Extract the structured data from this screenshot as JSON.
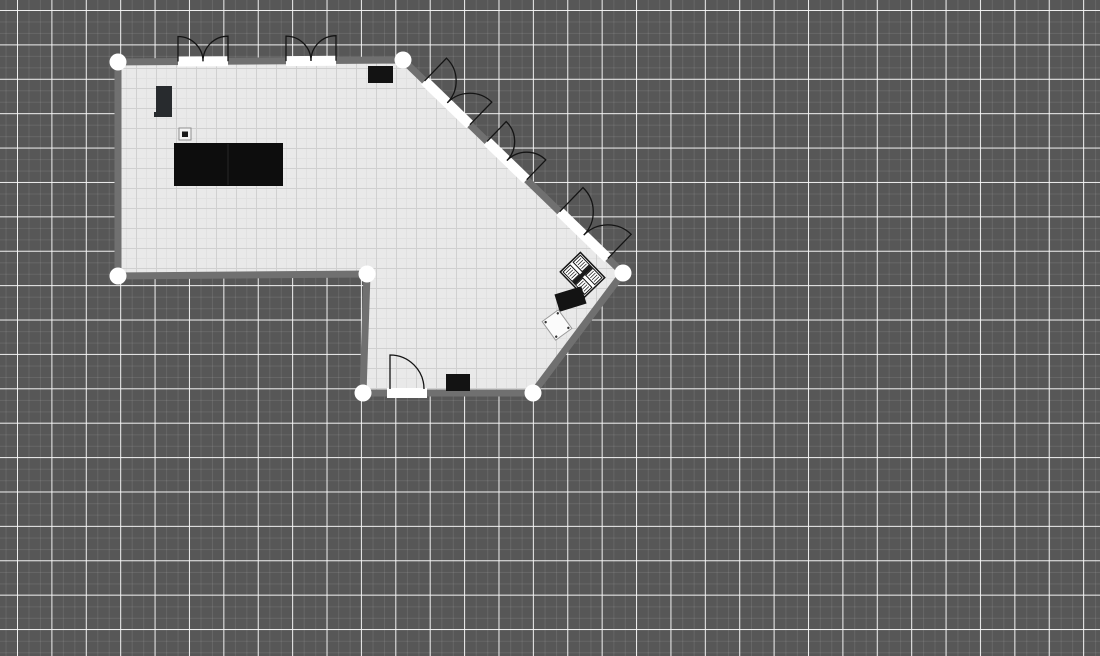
{
  "canvas": {
    "width": 1100,
    "height": 656,
    "tool": "floor-plan-editor-canvas"
  },
  "colors": {
    "canvas_background": "#575757",
    "grid_major": "#f2f2f2",
    "grid_fine": "#666666",
    "floor": "#e9e9e9",
    "floor_grid_minor": "#e1e1e1",
    "floor_grid_major": "#d0d0d0",
    "wall": "#707070",
    "opening": "#ffffff",
    "door_arc": "#141414",
    "vertex": "#ffffff",
    "furniture_dark": "#131313",
    "furniture_charcoal": "#282b2e"
  },
  "plan": {
    "room": {
      "polygon": [
        [
          118,
          62
        ],
        [
          403,
          60
        ],
        [
          623,
          273
        ],
        [
          533,
          393
        ],
        [
          363,
          393
        ],
        [
          367,
          274
        ],
        [
          118,
          276
        ]
      ],
      "wall_thickness": 7
    },
    "vertices": {
      "radius": 8.5,
      "points": [
        [
          118,
          62
        ],
        [
          403,
          60
        ],
        [
          623,
          273
        ],
        [
          533,
          393
        ],
        [
          363,
          393
        ],
        [
          367,
          274
        ],
        [
          118,
          276
        ]
      ]
    },
    "openings": [
      {
        "name": "top-door-opening-1",
        "x1": 178,
        "y1": 61.5,
        "x2": 228,
        "y2": 61.2
      },
      {
        "name": "top-door-opening-2",
        "x1": 286,
        "y1": 61.1,
        "x2": 336,
        "y2": 60.7
      },
      {
        "name": "diag-door-opening-1",
        "x1": 424.6,
        "y1": 80.9,
        "x2": 469.9,
        "y2": 124.7
      },
      {
        "name": "diag-door-opening-2",
        "x1": 487.1,
        "y1": 141.4,
        "x2": 526.7,
        "y2": 179.7
      },
      {
        "name": "diag-door-opening-3",
        "x1": 559.7,
        "y1": 211.7,
        "x2": 607.9,
        "y2": 258.4
      },
      {
        "name": "bottom-door-opening",
        "x1": 387,
        "y1": 393,
        "x2": 427,
        "y2": 393
      }
    ],
    "door_arcs": [
      {
        "name": "top-door-1-left-leaf",
        "path": "M178,61.5 L178,36.5 A25,25 0 0 1 203,61.3"
      },
      {
        "name": "top-door-1-right-leaf",
        "path": "M228,61.2 L228,36.2 A25,25 0 0 0 203,61.3"
      },
      {
        "name": "top-door-2-left-leaf",
        "path": "M286,61.1 L286,36.1 A25,25 0 0 1 311,60.9"
      },
      {
        "name": "top-door-2-right-leaf",
        "path": "M336,60.7 L336,35.7 A25,25 0 0 0 311,60.9"
      },
      {
        "name": "diag-door-1-left-leaf",
        "path": "M424.6,80.9 L446.5,58.2 A31.5,31.5 0 0 1 447.3,102.8"
      },
      {
        "name": "diag-door-1-right-leaf",
        "path": "M469.9,124.7 L491.8,102.1 A31.5,31.5 0 0 0 447.3,102.8"
      },
      {
        "name": "diag-door-2-left-leaf",
        "path": "M487.1,141.4 L506.2,121.6 A27.5,27.5 0 0 1 506.9,160.6"
      },
      {
        "name": "diag-door-2-right-leaf",
        "path": "M526.7,179.7 L545.8,159.9 A27.5,27.5 0 0 0 506.9,160.6"
      },
      {
        "name": "diag-door-3-left-leaf",
        "path": "M559.7,211.7 L583,187.6 A33.5,33.5 0 0 1 583.8,235.1"
      },
      {
        "name": "diag-door-3-right-leaf",
        "path": "M607.9,258.4 L631.2,234.3 A33.5,33.5 0 0 0 583.8,235.1"
      },
      {
        "name": "bottom-door-leaf",
        "path": "M390,389 L390,355 A34,34 0 0 1 424,389"
      }
    ],
    "furniture": [
      {
        "name": "wardrobe",
        "type": "rect",
        "x": 156,
        "y": 86,
        "w": 16,
        "h": 31,
        "fill": "#282b2e",
        "inner": {
          "x": 154,
          "y": 112,
          "w": 6,
          "h": 5,
          "fill": "#282b2e"
        }
      },
      {
        "name": "small-appliance",
        "type": "rect",
        "x": 179,
        "y": 128,
        "w": 12,
        "h": 12,
        "fill": "#f4f4f4",
        "stroke": "#909090",
        "inner": {
          "x": 182,
          "y": 131.5,
          "w": 6,
          "h": 5.5,
          "fill": "#1a1a1a"
        }
      },
      {
        "name": "table-large",
        "type": "rect",
        "x": 174,
        "y": 143,
        "w": 109,
        "h": 43,
        "fill": "#0d0d0d",
        "seam_x": 228
      },
      {
        "name": "box-top-right",
        "type": "rect",
        "x": 368,
        "y": 66,
        "w": 25,
        "h": 17,
        "fill": "#131313"
      },
      {
        "name": "box-bottom",
        "type": "rect",
        "x": 446,
        "y": 374,
        "w": 24,
        "h": 17,
        "fill": "#131313"
      },
      {
        "name": "stove",
        "type": "stove",
        "cx": 582.5,
        "cy": 274.8,
        "w": 35,
        "h": 28,
        "rotate": 46,
        "fill": "#ffffff",
        "stroke": "#141414"
      },
      {
        "name": "counter-black",
        "type": "rect",
        "cx": 570.5,
        "cy": 299,
        "w": 28,
        "h": 18,
        "rotate": -17,
        "fill": "#131313"
      },
      {
        "name": "sink",
        "type": "rect",
        "cx": 557,
        "cy": 325,
        "w": 20,
        "h": 23,
        "rotate": -36,
        "fill": "#fbfbfb",
        "stroke": "#999999",
        "dots": true
      }
    ]
  }
}
